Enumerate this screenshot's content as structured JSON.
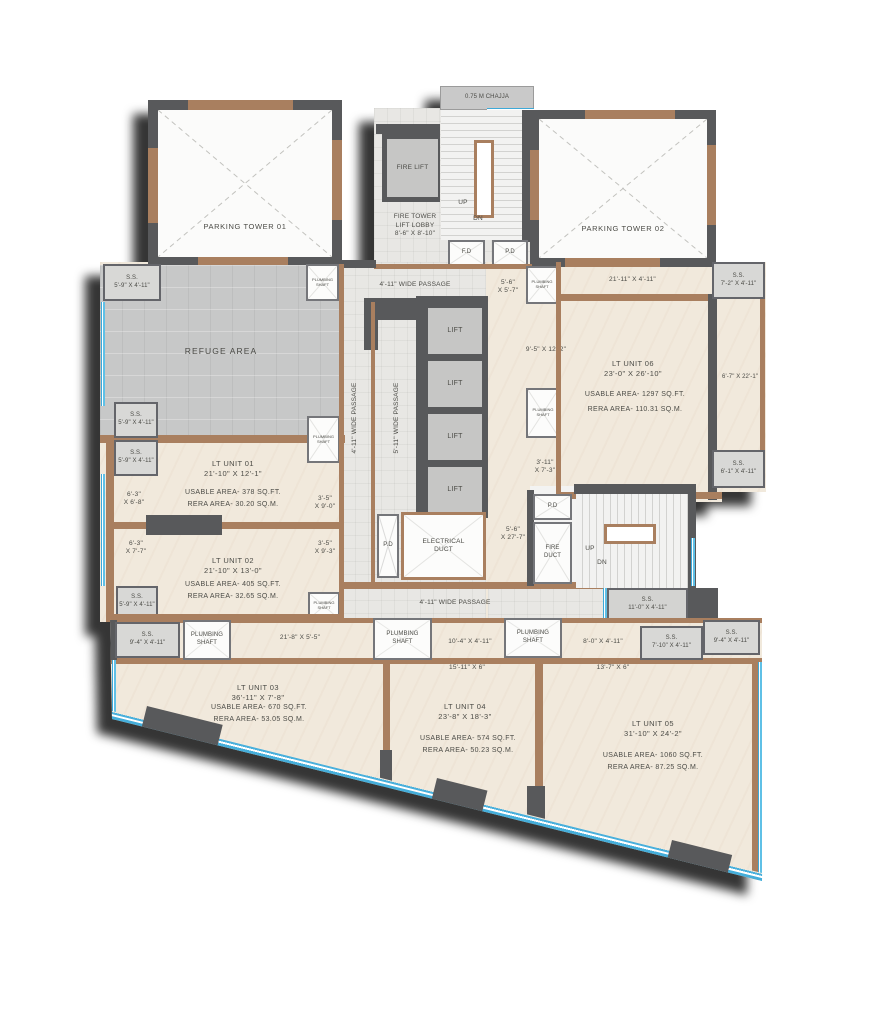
{
  "t": {
    "chajja": "0.75 M CHAJJA",
    "tower1": "PARKING TOWER 01",
    "tower2": "PARKING TOWER 02",
    "fire_lift": "FIRE LIFT",
    "lobby": "FIRE TOWER\nLIFT LOBBY\n8'-6\" X 8'-10\"",
    "up": "UP",
    "dn": "DN",
    "fd": "F.D",
    "pd": "P.D",
    "passage_4_11": "4'-11\" WIDE PASSAGE",
    "passage_5_11": "5'-11\" WIDE PASSAGE",
    "lift": "LIFT",
    "electrical_duct": "ELECTRICAL\nDUCT",
    "fire_duct": "FIRE\nDUCT",
    "plumbing_shaft": "PLUMBING\nSHAFT",
    "refuge": "REFUGE AREA",
    "ss_5_9": "S.S.\n5'-9\" X 4'-11\"",
    "ss_7_2": "S.S.\n7'-2\" X 4'-11\"",
    "ss_6_1": "S.S.\n6'-1\" X 4'-11\"",
    "ss_11_0": "S.S.\n11'-0\" X 4'-11\"",
    "ss_9_4": "S.S.\n9'-4\" X 4'-11\"",
    "ss_7_10": "S.S.\n7'-10\" X 4'-11\"",
    "d_5_6x5_7": "5'-6\"\nX 5'-7\"",
    "d_21_11x4_11": "21'-11\" X 4'-11\"",
    "d_9_5x12_2": "9'-5\" X 12'-2\"",
    "d_3_11x7_3": "3'-11\"\nX 7'-3\"",
    "d_6_7x22_1": "6'-7\" X 22'-1\"",
    "d_5_6x27_7": "5'-6\"\nX 27'-7\"",
    "d_6_3x6_8": "6'-3\"\nX 6'-8\"",
    "d_6_3x7_7": "6'-3\"\nX 7'-7\"",
    "d_3_5x9_0": "3'-5\"\nX 9'-0\"",
    "d_3_5x9_3": "3'-5\"\nX 9'-3\"",
    "d_21_8x5_5": "21'-8\" X 5'-5\"",
    "d_10_4x4_11": "10'-4\" X 4'-11\"",
    "d_8_0x4_11": "8'-0\" X 4'-11\"",
    "d_15_11x6": "15'-11\" X 6\"",
    "d_13_7x6": "13'-7\" X 6\""
  },
  "units": {
    "u1": {
      "title": "LT UNIT 01\n21'-10\" X 12'-1\"",
      "usable": "USABLE AREA- 378 SQ.FT.",
      "rera": "RERA AREA- 30.20 SQ.M."
    },
    "u2": {
      "title": "LT UNIT 02\n21'-10\" X 13'-0\"",
      "usable": "USABLE AREA- 405 SQ.FT.",
      "rera": "RERA AREA- 32.65 SQ.M."
    },
    "u3": {
      "title": "LT UNIT 03\n36'-11\" X 7'-8\"",
      "usable": "USABLE AREA- 670 SQ.FT.",
      "rera": "RERA AREA- 53.05 SQ.M."
    },
    "u4": {
      "title": "LT UNIT 04\n23'-8\" X 18'-3\"",
      "usable": "USABLE AREA- 574 SQ.FT.",
      "rera": "RERA AREA- 50.23 SQ.M."
    },
    "u5": {
      "title": "LT UNIT 05\n31'-10\" X 24'-2\"",
      "usable": "USABLE AREA- 1060 SQ.FT.",
      "rera": "RERA AREA- 87.25 SQ.M."
    },
    "u6": {
      "title": "LT UNIT 06\n23'-0\" X 26'-10\"",
      "usable": "USABLE AREA- 1297 SQ.FT.",
      "rera": "RERA AREA- 110.31 SQ.M."
    }
  },
  "colors": {
    "wall_dark": "#58595b",
    "wood": "#a97f5f",
    "floor_beige": "#f1e9dc",
    "floor_tile": "#e8e7e4",
    "refuge_gray": "#c7c8c8",
    "accent_blue": "#5fc0e6",
    "box_gray": "#d8d8d6",
    "lift_gray": "#c6c6c5"
  }
}
